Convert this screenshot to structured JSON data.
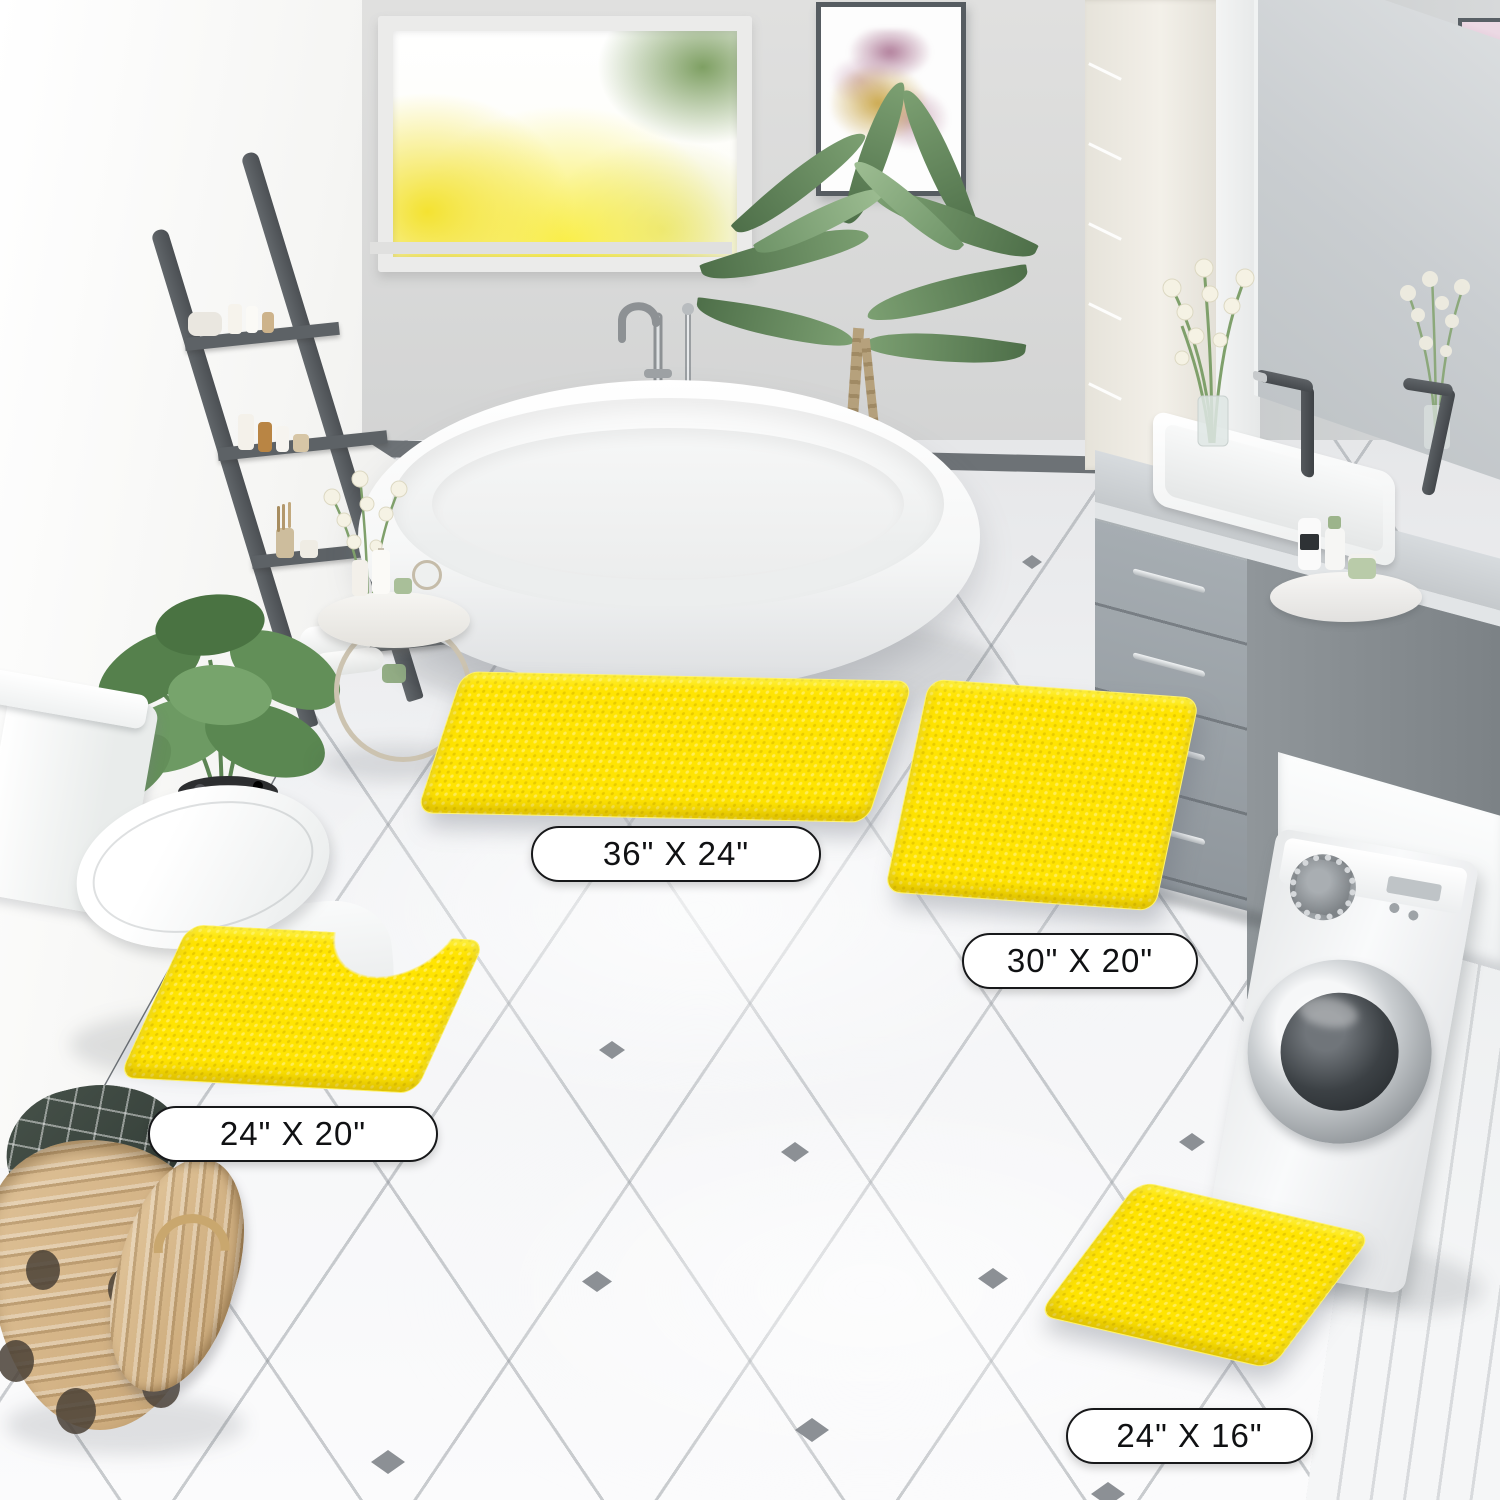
{
  "product_scene": {
    "description_labels": [
      {
        "name": "large-rectangle-rug",
        "size_label": "36\" X 24\""
      },
      {
        "name": "medium-rectangle-rug",
        "size_label": "30\" X 20\""
      },
      {
        "name": "contour-toilet-rug",
        "size_label": "24\" X 20\""
      },
      {
        "name": "small-rectangle-rug",
        "size_label": "24\" X 16\""
      }
    ],
    "colors": {
      "rug_yellow": "#FFE402",
      "label_background": "#FFFFFF",
      "label_border": "#1A1A1A",
      "label_text": "#111111",
      "tile_accent": "#82878C"
    }
  }
}
